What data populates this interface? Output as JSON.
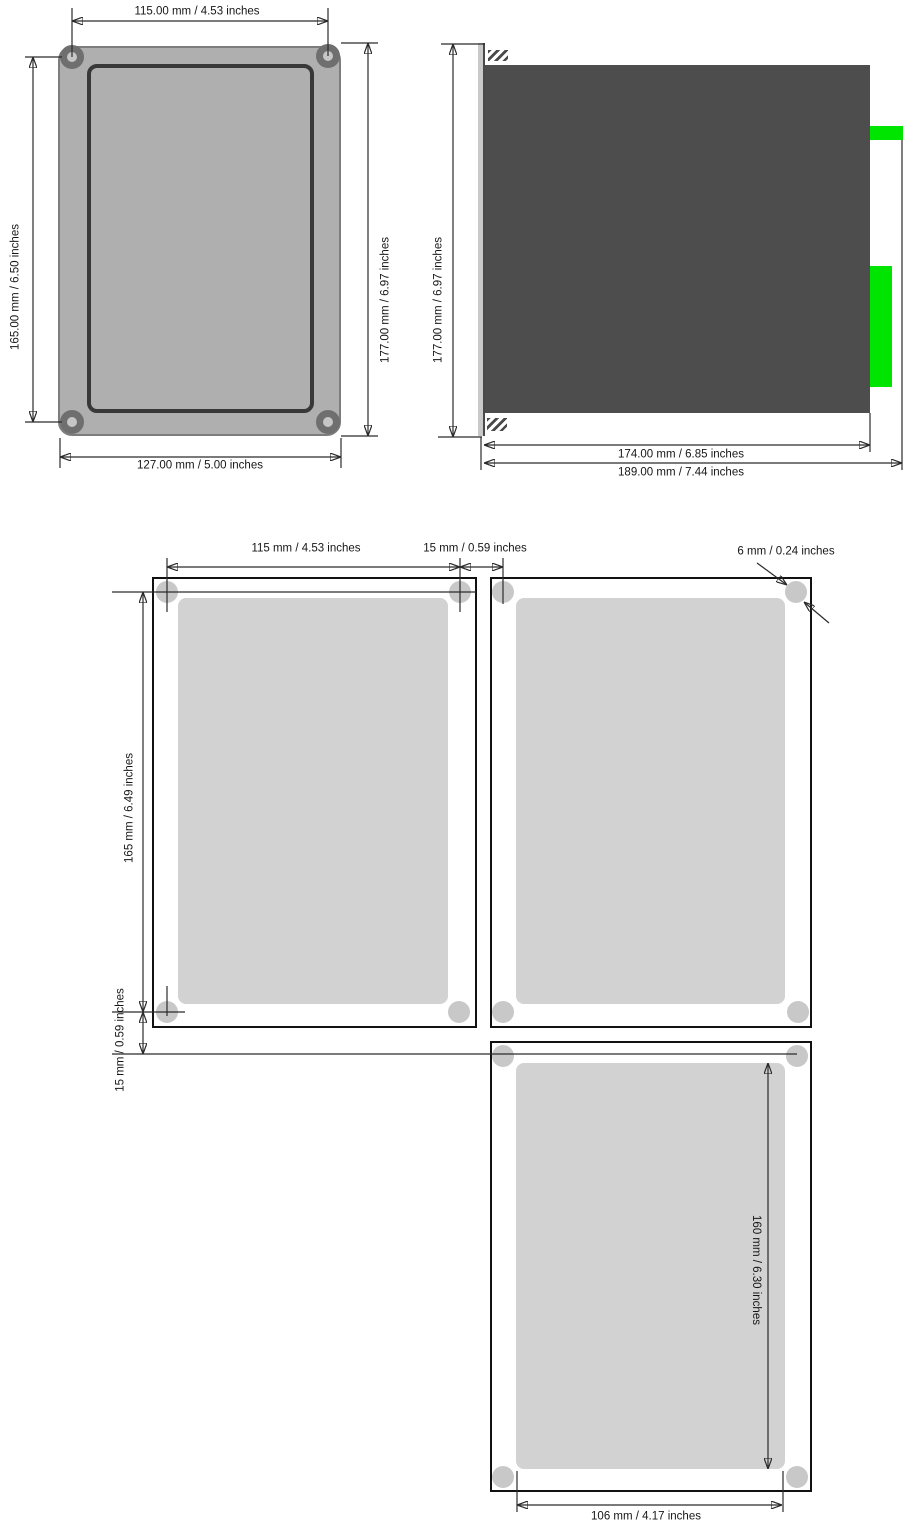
{
  "front_view": {
    "dim_top": "115.00 mm / 4.53 inches",
    "dim_left": "165.00 mm / 6.50 inches",
    "dim_right": "177.00 mm / 6.97 inches",
    "dim_bottom": "127.00 mm / 5.00 inches"
  },
  "side_view": {
    "dim_height": "177.00 mm / 6.97 inches",
    "dim_depth_body": "174.00 mm / 6.85 inches",
    "dim_depth_total": "189.00 mm / 7.44 inches"
  },
  "cutout_layout": {
    "dim_cutout_width": "115 mm / 4.53 inches",
    "dim_gap_horizontal": "15 mm / 0.59 inches",
    "dim_hole_diameter": "6 mm / 0.24 inches",
    "dim_cutout_height": "165 mm / 6.49 inches",
    "dim_gap_vertical": "15 mm / 0.59 inches",
    "dim_inner_height": "160 mm / 6.30 inches",
    "dim_inner_width": "106 mm / 4.17 inches"
  },
  "colors": {
    "panel_gray": "#AFAFAF",
    "body_dark_gray": "#4D4D4D",
    "connector_green": "#00E500",
    "cutout_fill": "#D2D2D2",
    "hole_fill": "#C8C8C8",
    "line": "#2B2B2B"
  }
}
